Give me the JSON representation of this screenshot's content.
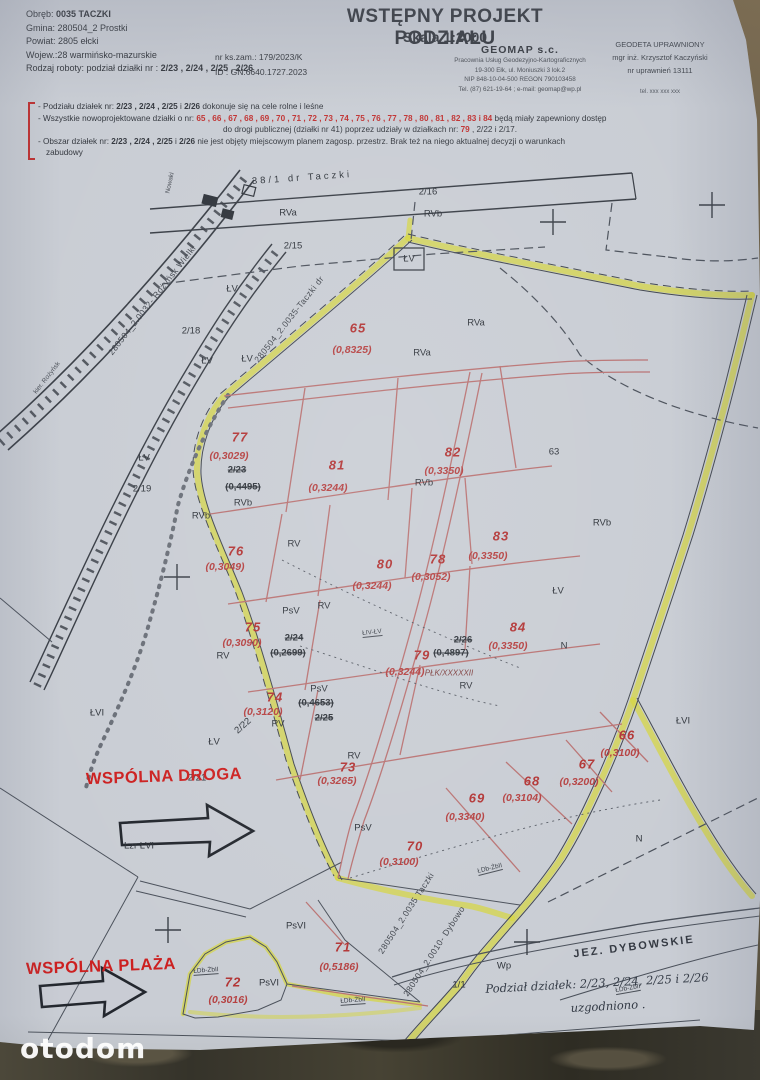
{
  "watermark": "otodom",
  "header": {
    "title": "WSTĘPNY PROJEKT PODZIAŁU",
    "scale": "Skala 1:2000",
    "nr_zam": "nr ks.zam.:   179/2023/K",
    "id": "ID :  GN.6640.1727.2023",
    "left_lines": [
      {
        "ind": 0,
        "s": [
          {
            "t": "Obręb: "
          },
          {
            "t": "0035  TACZKI",
            "b": 1
          }
        ]
      },
      {
        "ind": 0,
        "s": [
          {
            "t": "Gmina: 280504_2 Prostki"
          }
        ]
      },
      {
        "ind": 0,
        "s": [
          {
            "t": "Powiat: 2805 ełcki"
          }
        ]
      },
      {
        "ind": 0,
        "s": [
          {
            "t": "Wojew.:28 warmińsko-mazurskie"
          }
        ]
      },
      {
        "ind": 0,
        "s": [
          {
            "t": "Rodzaj roboty: podział działki nr : "
          },
          {
            "t": "2/23 , 2/24 , 2/25 , 2/26",
            "b": 1
          }
        ]
      }
    ],
    "company": {
      "name": "GEOMAP s.c.",
      "l1": "Pracownia Usług Geodezyjno-Kartograficznych",
      "l2": "19-300 Ełk, ul. Moniuszki 3 lok.2",
      "l3": "NIP 848-10-04-500  REGON 790103458",
      "l4": "Tel. (87) 621-19-64 ; e-mail: geomap@wp.pl"
    },
    "surveyor": {
      "l1": "GEODETA  UPRAWNIONY",
      "l2": "mgr inż. Krzysztof Kaczyński",
      "l3": "nr uprawnień 13111",
      "tel": "tel. xxx xxx xxx"
    }
  },
  "notes": {
    "lines": [
      {
        "ind": 0,
        "s": [
          {
            "t": "- Podziału działek  nr: "
          },
          {
            "t": "2/23 , 2/24 , 2/25",
            "b": 1
          },
          {
            "t": " i "
          },
          {
            "t": "2/26",
            "b": 1
          },
          {
            "t": "  dokonuje się na cele rolne i leśne"
          }
        ]
      },
      {
        "ind": 0,
        "s": [
          {
            "t": "- Wszystkie nowoprojektowane działki o nr: "
          },
          {
            "t": "65 , 66 , 67 , 68 , 69 , 70 , 71 , 72 , 73 , 74 , 75 , 76 , 77 , 78 , 80 , 81 , 82 , 83 i 84",
            "red": 1
          },
          {
            "t": " będą miały zapewniony  dostęp"
          }
        ]
      },
      {
        "ind": 185,
        "s": [
          {
            "t": "do drogi publicznej (działki nr 41) poprzez udziały w działkach nr: "
          },
          {
            "t": "79",
            "red": 1
          },
          {
            "t": " , 2/22 i 2/17."
          }
        ]
      },
      {
        "ind": 0,
        "s": [
          {
            "t": "- Obszar działek  nr: "
          },
          {
            "t": "2/23 , 2/24 , 2/25",
            "b": 1
          },
          {
            "t": " i "
          },
          {
            "t": "2/26",
            "b": 1
          },
          {
            "t": "  nie jest objęty  miejscowym  planem  zagosp.  przestrz.  Brak też na niego aktualnej decyzji o warunkach"
          }
        ]
      },
      {
        "ind": 8,
        "s": [
          {
            "t": "zabudowy"
          }
        ]
      }
    ]
  },
  "map": {
    "labels": [
      {
        "t": "38/1   dr  Taczki",
        "x": 302,
        "y": 178,
        "c": "roadname",
        "r": -4
      },
      {
        "t": "2/16",
        "x": 428,
        "y": 192,
        "c": "blk"
      },
      {
        "t": "RVb",
        "x": 433,
        "y": 214,
        "c": "blk"
      },
      {
        "t": "RVa",
        "x": 288,
        "y": 213,
        "c": "blk"
      },
      {
        "t": "2/15",
        "x": 293,
        "y": 246,
        "c": "blk"
      },
      {
        "t": "ŁV",
        "x": 409,
        "y": 259,
        "c": "blk"
      },
      {
        "t": "ŁV",
        "x": 232,
        "y": 289,
        "c": "blk"
      },
      {
        "t": "2/18",
        "x": 191,
        "y": 331,
        "c": "blk"
      },
      {
        "t": "ŁV",
        "x": 207,
        "y": 361,
        "c": "blk"
      },
      {
        "t": "ŁV",
        "x": 247,
        "y": 359,
        "c": "blk"
      },
      {
        "t": "RVa",
        "x": 476,
        "y": 323,
        "c": "blk"
      },
      {
        "t": "RVa",
        "x": 422,
        "y": 353,
        "c": "blk"
      },
      {
        "t": "63",
        "x": 554,
        "y": 452,
        "c": "blk"
      },
      {
        "t": "RVb",
        "x": 424,
        "y": 483,
        "c": "blk"
      },
      {
        "t": "ŁV",
        "x": 144,
        "y": 458,
        "c": "blk"
      },
      {
        "t": "2/19",
        "x": 142,
        "y": 489,
        "c": "blk"
      },
      {
        "t": "RVb",
        "x": 243,
        "y": 503,
        "c": "blk"
      },
      {
        "t": "RVb",
        "x": 201,
        "y": 516,
        "c": "blk"
      },
      {
        "t": "RVb",
        "x": 602,
        "y": 523,
        "c": "blk"
      },
      {
        "t": "RV",
        "x": 294,
        "y": 544,
        "c": "blk"
      },
      {
        "t": "PsV",
        "x": 291,
        "y": 611,
        "c": "blk"
      },
      {
        "t": "RV",
        "x": 324,
        "y": 606,
        "c": "blk"
      },
      {
        "t": "ŁV",
        "x": 558,
        "y": 591,
        "c": "blk"
      },
      {
        "t": "RV",
        "x": 223,
        "y": 656,
        "c": "blk"
      },
      {
        "t": "PsV",
        "x": 319,
        "y": 689,
        "c": "blk"
      },
      {
        "t": "RV",
        "x": 466,
        "y": 686,
        "c": "blk"
      },
      {
        "t": "N",
        "x": 564,
        "y": 646,
        "c": "blk"
      },
      {
        "t": "RV",
        "x": 278,
        "y": 724,
        "c": "blk"
      },
      {
        "t": "2/22",
        "x": 243,
        "y": 726,
        "c": "blk",
        "r": -42
      },
      {
        "t": "ŁVI",
        "x": 683,
        "y": 721,
        "c": "blk"
      },
      {
        "t": "ŁVI",
        "x": 97,
        "y": 713,
        "c": "blk"
      },
      {
        "t": "ŁV",
        "x": 214,
        "y": 742,
        "c": "blk"
      },
      {
        "t": "2/21",
        "x": 197,
        "y": 778,
        "c": "blk"
      },
      {
        "t": "Lzr ŁVI",
        "x": 139,
        "y": 846,
        "c": "blk"
      },
      {
        "t": "RV",
        "x": 354,
        "y": 756,
        "c": "blk"
      },
      {
        "t": "PsV",
        "x": 363,
        "y": 828,
        "c": "blk"
      },
      {
        "t": "N",
        "x": 639,
        "y": 839,
        "c": "blk"
      },
      {
        "t": "PsVI",
        "x": 296,
        "y": 926,
        "c": "blk"
      },
      {
        "t": "PsVI",
        "x": 269,
        "y": 983,
        "c": "blk"
      },
      {
        "t": "Wp",
        "x": 504,
        "y": 966,
        "c": "blk"
      },
      {
        "t": "1/1",
        "x": 459,
        "y": 985,
        "c": "blk"
      },
      {
        "t": "JEZ. DYBOWSKIE",
        "x": 634,
        "y": 947,
        "c": "lake",
        "r": -7
      },
      {
        "t": "2/23",
        "x": 237,
        "y": 470,
        "c": "struck"
      },
      {
        "t": "(0,4495)",
        "x": 243,
        "y": 487,
        "c": "struck"
      },
      {
        "t": "2/24",
        "x": 294,
        "y": 638,
        "c": "struck"
      },
      {
        "t": "(0,2699)",
        "x": 288,
        "y": 653,
        "c": "struck"
      },
      {
        "t": "(0,4653)",
        "x": 316,
        "y": 703,
        "c": "struck"
      },
      {
        "t": "2/25",
        "x": 324,
        "y": 718,
        "c": "struck"
      },
      {
        "t": "2/26",
        "x": 463,
        "y": 640,
        "c": "struck"
      },
      {
        "t": "(0,4897)",
        "x": 451,
        "y": 653,
        "c": "struck"
      },
      {
        "t": "65",
        "x": 358,
        "y": 328,
        "c": "lot"
      },
      {
        "t": "(0,8325)",
        "x": 352,
        "y": 350,
        "c": "area"
      },
      {
        "t": "77",
        "x": 240,
        "y": 437,
        "c": "lot"
      },
      {
        "t": "(0,3029)",
        "x": 229,
        "y": 456,
        "c": "area"
      },
      {
        "t": "81",
        "x": 337,
        "y": 465,
        "c": "lot"
      },
      {
        "t": "(0,3244)",
        "x": 328,
        "y": 488,
        "c": "area"
      },
      {
        "t": "82",
        "x": 453,
        "y": 452,
        "c": "lot"
      },
      {
        "t": "(0,3350)",
        "x": 444,
        "y": 471,
        "c": "area"
      },
      {
        "t": "83",
        "x": 501,
        "y": 536,
        "c": "lot"
      },
      {
        "t": "(0,3350)",
        "x": 488,
        "y": 556,
        "c": "area"
      },
      {
        "t": "76",
        "x": 236,
        "y": 551,
        "c": "lot"
      },
      {
        "t": "(0,3049)",
        "x": 225,
        "y": 567,
        "c": "area"
      },
      {
        "t": "80",
        "x": 385,
        "y": 564,
        "c": "lot"
      },
      {
        "t": "(0,3244)",
        "x": 372,
        "y": 586,
        "c": "area"
      },
      {
        "t": "78",
        "x": 438,
        "y": 559,
        "c": "lot"
      },
      {
        "t": "(0,3052)",
        "x": 431,
        "y": 577,
        "c": "area"
      },
      {
        "t": "75",
        "x": 253,
        "y": 627,
        "c": "lot"
      },
      {
        "t": "(0,3090)",
        "x": 242,
        "y": 643,
        "c": "area"
      },
      {
        "t": "79",
        "x": 422,
        "y": 655,
        "c": "lot"
      },
      {
        "t": "(0,3244)",
        "x": 405,
        "y": 672,
        "c": "area"
      },
      {
        "t": "84",
        "x": 518,
        "y": 627,
        "c": "lot"
      },
      {
        "t": "(0,3350)",
        "x": 508,
        "y": 646,
        "c": "area"
      },
      {
        "t": "74",
        "x": 275,
        "y": 697,
        "c": "lot"
      },
      {
        "t": "(0,3120)",
        "x": 263,
        "y": 712,
        "c": "area"
      },
      {
        "t": "73",
        "x": 348,
        "y": 767,
        "c": "lot"
      },
      {
        "t": "(0,3265)",
        "x": 337,
        "y": 781,
        "c": "area"
      },
      {
        "t": "66",
        "x": 627,
        "y": 735,
        "c": "lot"
      },
      {
        "t": "(0,3100)",
        "x": 620,
        "y": 753,
        "c": "area"
      },
      {
        "t": "67",
        "x": 587,
        "y": 764,
        "c": "lot"
      },
      {
        "t": "(0,3200)",
        "x": 579,
        "y": 782,
        "c": "area"
      },
      {
        "t": "68",
        "x": 532,
        "y": 781,
        "c": "lot"
      },
      {
        "t": "(0,3104)",
        "x": 522,
        "y": 798,
        "c": "area"
      },
      {
        "t": "69",
        "x": 477,
        "y": 798,
        "c": "lot"
      },
      {
        "t": "(0,3340)",
        "x": 465,
        "y": 817,
        "c": "area"
      },
      {
        "t": "70",
        "x": 415,
        "y": 846,
        "c": "lot"
      },
      {
        "t": "(0,3100)",
        "x": 399,
        "y": 862,
        "c": "area"
      },
      {
        "t": "71",
        "x": 343,
        "y": 947,
        "c": "lot"
      },
      {
        "t": "(0,5186)",
        "x": 339,
        "y": 967,
        "c": "area"
      },
      {
        "t": "72",
        "x": 233,
        "y": 982,
        "c": "lot"
      },
      {
        "t": "(0,3016)",
        "x": 228,
        "y": 1000,
        "c": "area"
      },
      {
        "t": "PŁK/XXXXXII",
        "x": 449,
        "y": 673,
        "c": "scrib"
      },
      {
        "t": "WSPÓLNA DROGA",
        "x": 164,
        "y": 777,
        "c": "annot",
        "r": -2
      },
      {
        "t": "WSPÓLNA PLAŻA",
        "x": 101,
        "y": 967,
        "c": "annot",
        "r": -2
      },
      {
        "t": "ŁIV-ŁV",
        "x": 372,
        "y": 633,
        "c": "code",
        "r": -6
      },
      {
        "t": "ŁDb-ŻbII",
        "x": 490,
        "y": 869,
        "c": "code",
        "r": -14
      },
      {
        "t": "ŁDb-ŻbII",
        "x": 206,
        "y": 971,
        "c": "code",
        "r": -4
      },
      {
        "t": "ŁDb-ŻbII",
        "x": 353,
        "y": 1001,
        "c": "code",
        "r": -4
      },
      {
        "t": "ŁDb-ŻbII",
        "x": 628,
        "y": 989,
        "c": "code",
        "r": -10
      },
      {
        "t": "280504_2.0032- Rożyńsk Wielki",
        "x": 152,
        "y": 300,
        "c": "diag",
        "r": -52
      },
      {
        "t": "280504_2.0035-Taczki  dr",
        "x": 289,
        "y": 319,
        "c": "diag",
        "r": -52
      },
      {
        "t": "280504_2.0035 Taczki",
        "x": 406,
        "y": 913,
        "c": "diag",
        "r": -57
      },
      {
        "t": "280504_2.0010- Dybowo",
        "x": 434,
        "y": 951,
        "c": "diag",
        "r": -57
      },
      {
        "t": "kier. Rożyńsk",
        "x": 47,
        "y": 378,
        "c": "tiny",
        "r": -52
      },
      {
        "t": "Nowaki",
        "x": 170,
        "y": 183,
        "c": "tiny",
        "r": -78
      },
      {
        "t": "Podział działek: 2/23, 2/24, 2/25 i 2/26",
        "x": 597,
        "y": 983,
        "c": "hand",
        "r": -3
      },
      {
        "t": "uzgodniono .",
        "x": 608,
        "y": 1006,
        "c": "hand",
        "r": -3
      }
    ]
  }
}
